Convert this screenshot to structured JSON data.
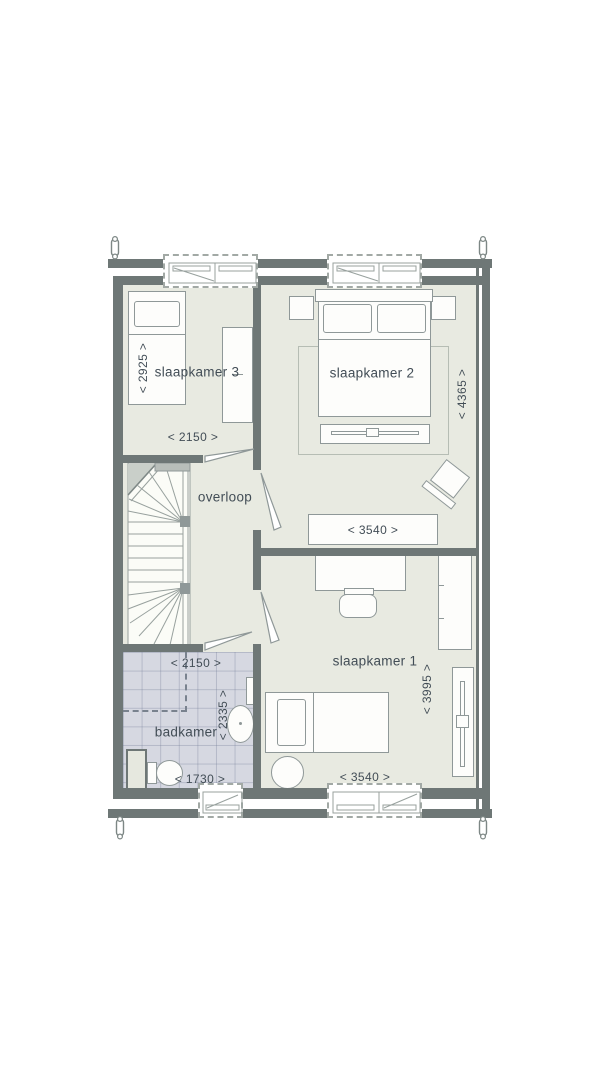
{
  "plan_title": "floor-plan-first-floor",
  "rooms": {
    "slaapkamer3": {
      "label": "slaapkamer 3",
      "dim_depth": "< 2925 >",
      "dim_width": "< 2150 >"
    },
    "slaapkamer2": {
      "label": "slaapkamer 2",
      "dim_depth": "< 4365 >",
      "dim_width": "< 3540 >"
    },
    "slaapkamer1": {
      "label": "slaapkamer 1",
      "dim_depth": "< 3995 >",
      "dim_width": "< 3540 >"
    },
    "overloop": {
      "label": "overloop"
    },
    "badkamer": {
      "label": "badkamer",
      "dim_width_top": "< 2150 >",
      "dim_depth": "< 2335 >",
      "dim_width_bottom": "< 1730 >"
    }
  },
  "fixtures": {
    "badkamer": [
      "shower-area",
      "washbasin",
      "toilet",
      "radiator",
      "duct"
    ],
    "circulation": [
      "winder-staircase",
      "door-slaapkamer-3",
      "door-slaapkamer-2",
      "door-slaapkamer-1",
      "door-badkamer"
    ],
    "slaapkamer3": [
      "single-bed",
      "wardrobe"
    ],
    "slaapkamer2": [
      "double-bed",
      "nightstand-left",
      "nightstand-right",
      "rug",
      "tv-bench",
      "armchair",
      "sideboard"
    ],
    "slaapkamer1": [
      "desk",
      "desk-chair",
      "wardrobe",
      "sliding-wardrobe",
      "single-bed",
      "pouf"
    ],
    "envelope": [
      "window-top-left",
      "window-top-right",
      "window-bottom-bathroom",
      "window-bottom-bedroom",
      "wall-anchor-top-left",
      "wall-anchor-top-right",
      "wall-anchor-bottom-left",
      "wall-anchor-bottom-right"
    ]
  },
  "colors": {
    "wall": "#6e7776",
    "room_fill": "#e8eae1",
    "bathroom_tile": "#d6d8e1",
    "stair_fill": "#fbfcf7",
    "furniture_outline": "#8f9898",
    "text": "#424d56",
    "background": "#ffffff"
  }
}
